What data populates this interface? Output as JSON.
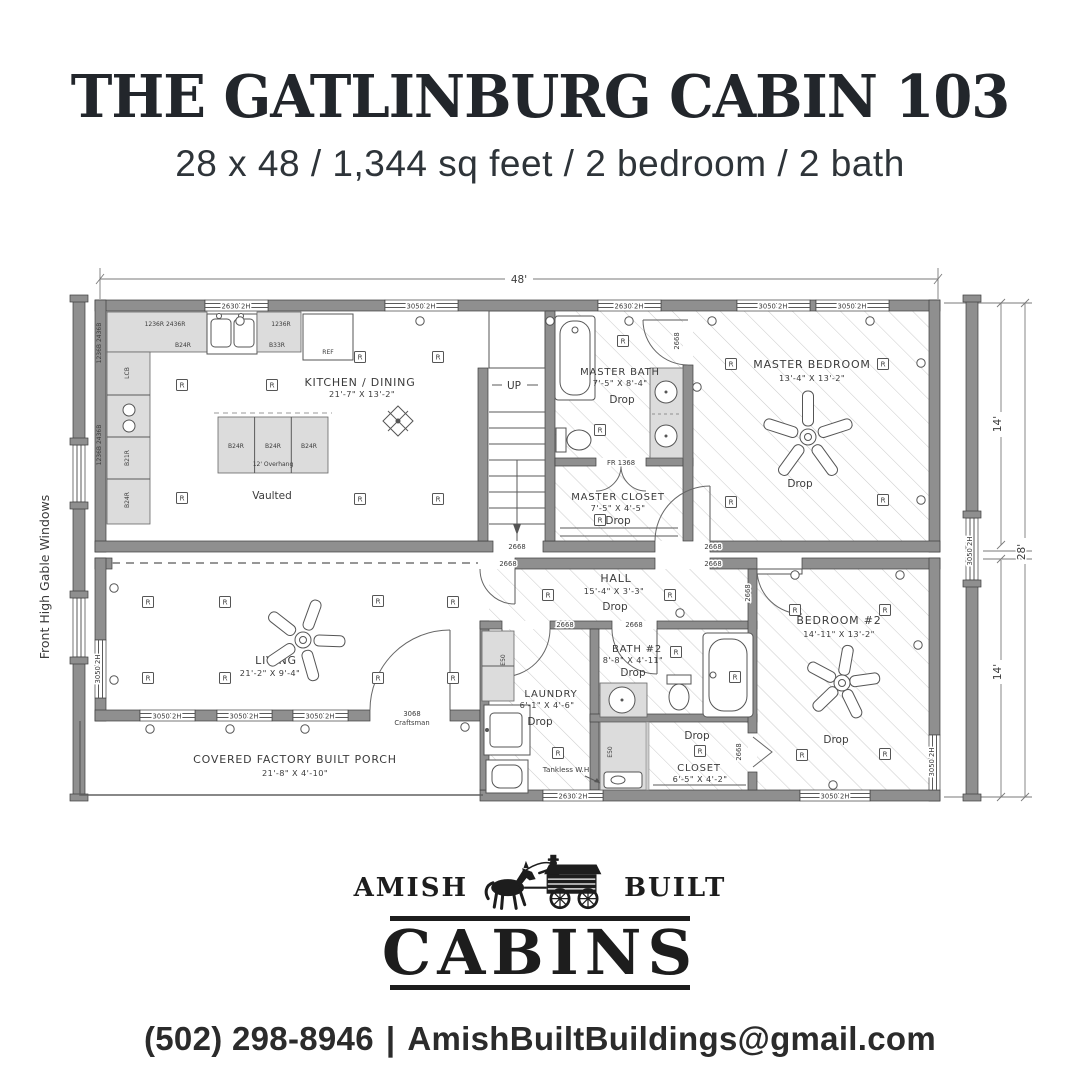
{
  "header": {
    "title": "THE GATLINBURG CABIN 103",
    "subtitle": "28 x 48 / 1,344 sq feet / 2 bedroom / 2 bath"
  },
  "plan": {
    "dimensions": {
      "overall_width": "48'",
      "upper_depth": "14'",
      "overall_depth": "28'",
      "lower_depth": "14'"
    },
    "side_note": "Front High Gable Windows",
    "stairs_label": "UP",
    "rooms": {
      "kitchen": {
        "name": "KITCHEN / DINING",
        "size": "21'-7\" X 13'-2\"",
        "ceiling": "Vaulted",
        "island_cabs": [
          "B24R",
          "B24R",
          "B24R"
        ],
        "island_note": "12' Overhang"
      },
      "master_bath": {
        "name": "MASTER BATH",
        "size": "7'-5\" X 8'-4\"",
        "ceiling": "Drop"
      },
      "master_closet": {
        "name": "MASTER CLOSET",
        "size": "7'-5\" X 4'-5\"",
        "ceiling": "Drop"
      },
      "master_bedroom": {
        "name": "MASTER BEDROOM",
        "size": "13'-4\" X 13'-2\"",
        "ceiling": "Drop"
      },
      "living": {
        "name": "LIVING",
        "size": "21'-2\" X 9'-4\""
      },
      "hall": {
        "name": "HALL",
        "size": "15'-4\" X 3'-3\"",
        "ceiling": "Drop"
      },
      "laundry": {
        "name": "LAUNDRY",
        "size": "6'-1\" X 4'-6\"",
        "ceiling": "Drop"
      },
      "bath2": {
        "name": "BATH #2",
        "size": "8'-8\" X 4'-11\"",
        "ceiling": "Drop"
      },
      "closet2": {
        "name": "CLOSET",
        "size": "6'-5\" X 4'-2\"",
        "ceiling": "Drop"
      },
      "bedroom2": {
        "name": "BEDROOM #2",
        "size": "14'-11\" X 13'-2\"",
        "ceiling": "Drop"
      },
      "porch": {
        "name": "COVERED FACTORY BUILT PORCH",
        "size": "21'-8\" X 4'-10\""
      }
    },
    "openings": {
      "window_3050": "3050 2H",
      "window_2630": "2630 2H",
      "door_2668": "2668",
      "door_3068": "3068",
      "door_3068_style": "Craftsman",
      "french_door": "FR 1368"
    },
    "symbols": {
      "recessed_light": "R"
    },
    "cabinets": {
      "wall_run": "1236R 2436R",
      "wall_1236r": "1236R",
      "b24r": "B24R",
      "b33r": "B33R",
      "lcb": "LCB",
      "b21r": "B21R",
      "e50": "E50",
      "ref": "REF",
      "left_stack": "1236B 2436B"
    },
    "notes": {
      "tankless": "Tankless W.H"
    }
  },
  "logo": {
    "word_left": "AMISH",
    "word_right": "BUILT",
    "word_main": "CABINS"
  },
  "contact": {
    "phone": "(502) 298-8946",
    "separator": "|",
    "email": "AmishBuiltBuildings@gmail.com"
  }
}
